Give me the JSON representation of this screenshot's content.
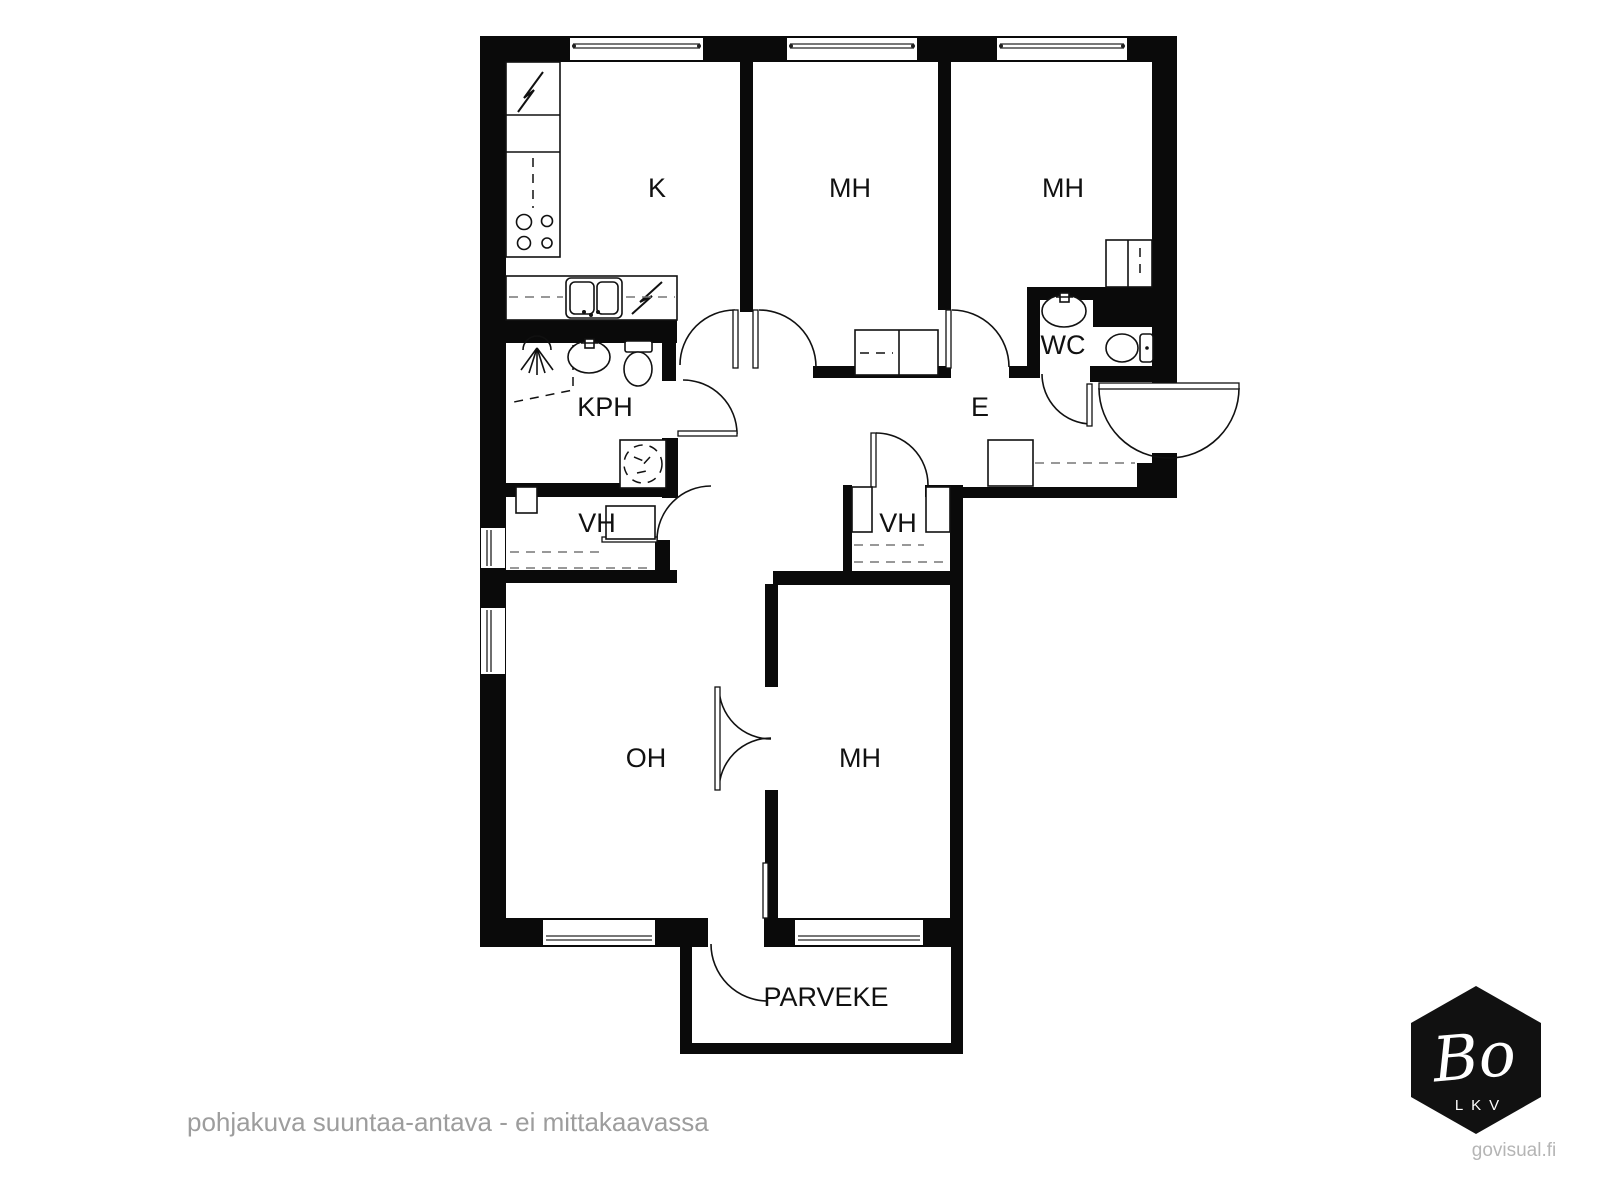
{
  "plan": {
    "type": "floor-plan",
    "rooms": [
      {
        "label": "K"
      },
      {
        "label": "MH"
      },
      {
        "label": "MH"
      },
      {
        "label": "WC"
      },
      {
        "label": "KPH"
      },
      {
        "label": "E"
      },
      {
        "label": "VH"
      },
      {
        "label": "VH"
      },
      {
        "label": "OH"
      },
      {
        "label": "MH"
      },
      {
        "label": "PARVEKE"
      }
    ],
    "fixture_icons": [
      "electrical-bolt-icon",
      "stove-icon",
      "kitchen-sink-icon",
      "dishwasher-bolt-icon",
      "shower-icon",
      "washbasin-icon",
      "toilet-icon",
      "washing-machine-icon",
      "wardrobe-icon",
      "door-swing-icon",
      "window-icon"
    ],
    "colors": {
      "walls": "#0a0a0a",
      "background": "#ffffff",
      "muted_text": "#9d9d9d",
      "light_text": "#b5b5b5",
      "logo_bg": "#111111"
    }
  },
  "footer": {
    "disclaimer": "pohjakuva suuntaa-antava - ei mittakaavassa",
    "website": "govisual.fi"
  },
  "logo": {
    "brand": "Bo",
    "subtitle": "LKV"
  }
}
